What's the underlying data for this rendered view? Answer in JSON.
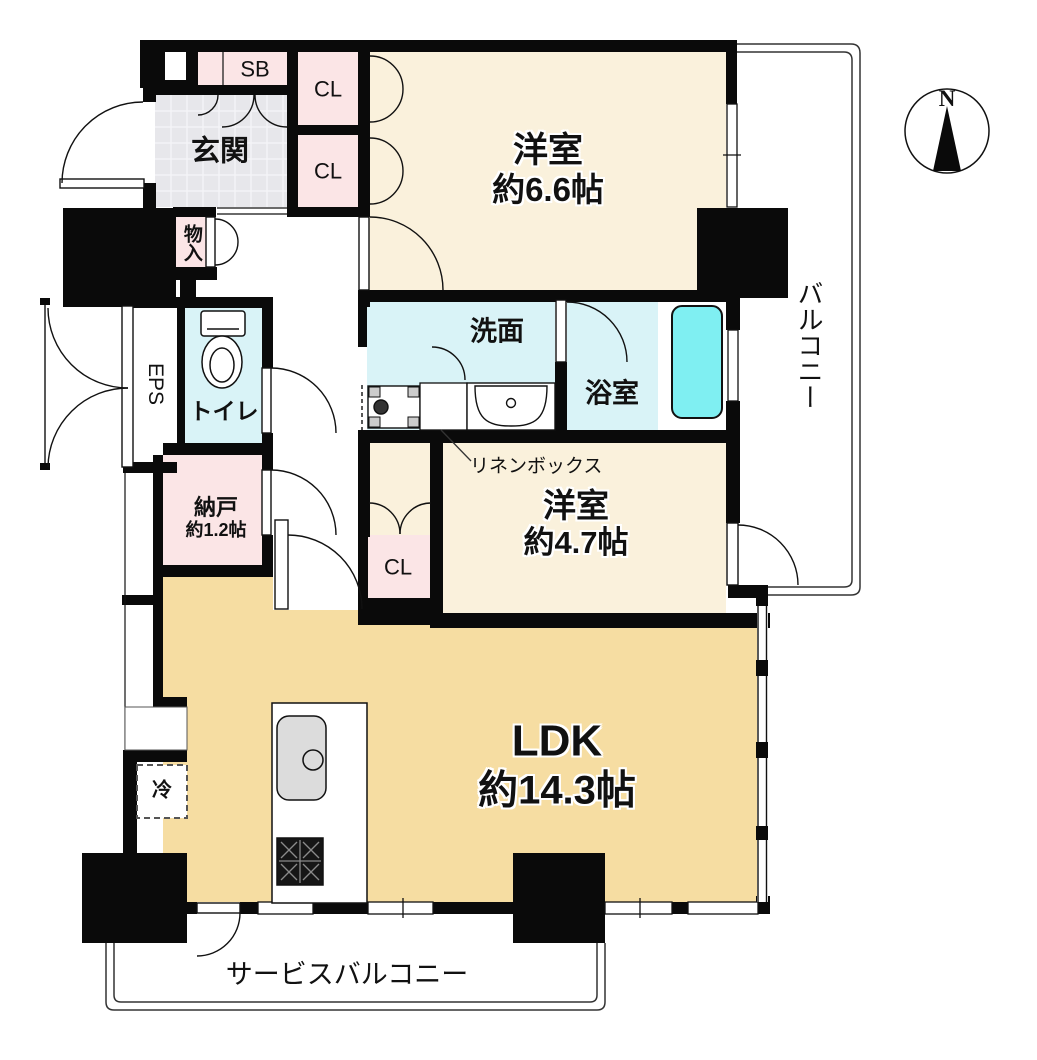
{
  "floorplan": {
    "compass": {
      "north_label": "N"
    },
    "rooms": {
      "genkan": {
        "label": "玄関"
      },
      "shoe_box": {
        "label": "SB"
      },
      "closet_upper_1": {
        "label": "CL"
      },
      "closet_upper_2": {
        "label": "CL"
      },
      "storage_small": {
        "label": "物入"
      },
      "western_room_66": {
        "label": "洋室",
        "area": "約6.6帖"
      },
      "balcony": {
        "label": "バルコニー"
      },
      "washroom": {
        "label": "洗面"
      },
      "bathroom": {
        "label": "浴室"
      },
      "toilet": {
        "label": "トイレ"
      },
      "eps": {
        "label": "EPS"
      },
      "storage_nando": {
        "label": "納戸",
        "area": "約1.2帖"
      },
      "linen_box": {
        "label": "リネンボックス"
      },
      "western_room_47": {
        "label": "洋室",
        "area": "約4.7帖"
      },
      "closet_lower": {
        "label": "CL"
      },
      "ldk": {
        "label": "LDK",
        "area": "約14.3帖"
      },
      "refrigerator": {
        "label": "冷"
      },
      "service_balcony": {
        "label": "サービスバルコニー"
      }
    },
    "colors": {
      "wall": "#0a0a0a",
      "room_cream": "#FAF1DC",
      "ldk_tan": "#F6DDA2",
      "wet_cyan": "#D9F3F7",
      "tub_cyan": "#7FEFF2",
      "closet_pink": "#FBE5E6",
      "genkan_gray": "#E7E7EB"
    }
  }
}
